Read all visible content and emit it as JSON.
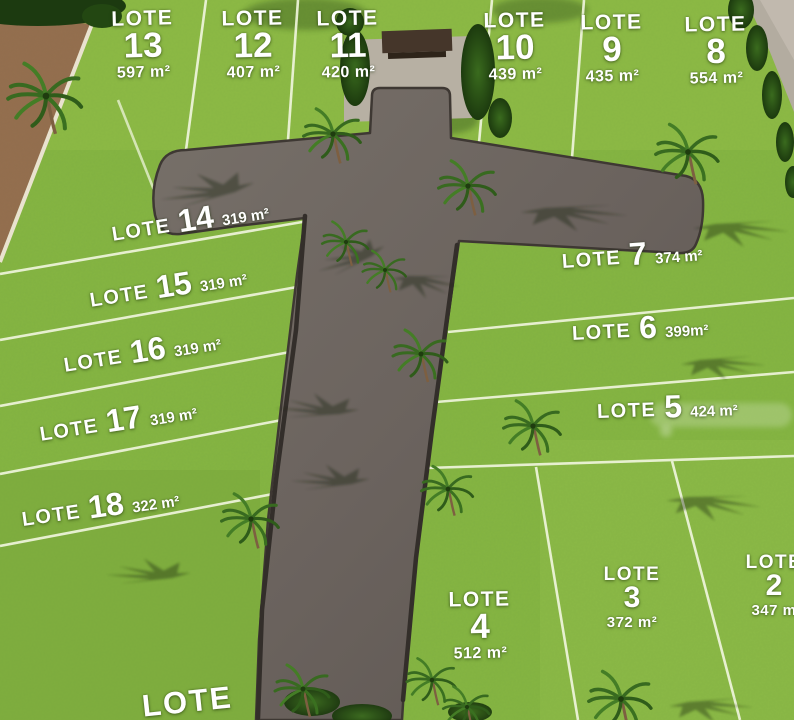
{
  "lots": [
    {
      "name": "LOTE",
      "number": "13",
      "area": "597 m²"
    },
    {
      "name": "LOTE",
      "number": "12",
      "area": "407 m²"
    },
    {
      "name": "LOTE",
      "number": "11",
      "area": "420 m²"
    },
    {
      "name": "LOTE",
      "number": "10",
      "area": "439 m²"
    },
    {
      "name": "LOTE",
      "number": "9",
      "area": "435 m²"
    },
    {
      "name": "LOTE",
      "number": "8",
      "area": "554 m²"
    },
    {
      "name": "LOTE",
      "number": "14",
      "area": "319 m²"
    },
    {
      "name": "LOTE",
      "number": "15",
      "area": "319 m²"
    },
    {
      "name": "LOTE",
      "number": "16",
      "area": "319 m²"
    },
    {
      "name": "LOTE",
      "number": "17",
      "area": "319 m²"
    },
    {
      "name": "LOTE",
      "number": "18",
      "area": "322 m²"
    },
    {
      "name": "LOTE",
      "number": "7",
      "area": "374 m²"
    },
    {
      "name": "LOTE",
      "number": "6",
      "area": "399m²"
    },
    {
      "name": "LOTE",
      "number": "5",
      "area": "424 m²"
    },
    {
      "name": "LOTE",
      "number": "3",
      "area": "372 m²"
    },
    {
      "name": "LOTE",
      "number": "2",
      "area": "347 m"
    },
    {
      "name": "LOTE",
      "number": "4",
      "area": "512 m²"
    },
    {
      "name": "LOTE",
      "number": "",
      "area": ""
    }
  ],
  "colors": {
    "grass": "#85B542",
    "road": "#6E6560",
    "boundary_line": "#EFF5DC",
    "mulch": "#936E4E",
    "label_text": "#FFFFFF",
    "foliage": "#2E5A1D"
  }
}
